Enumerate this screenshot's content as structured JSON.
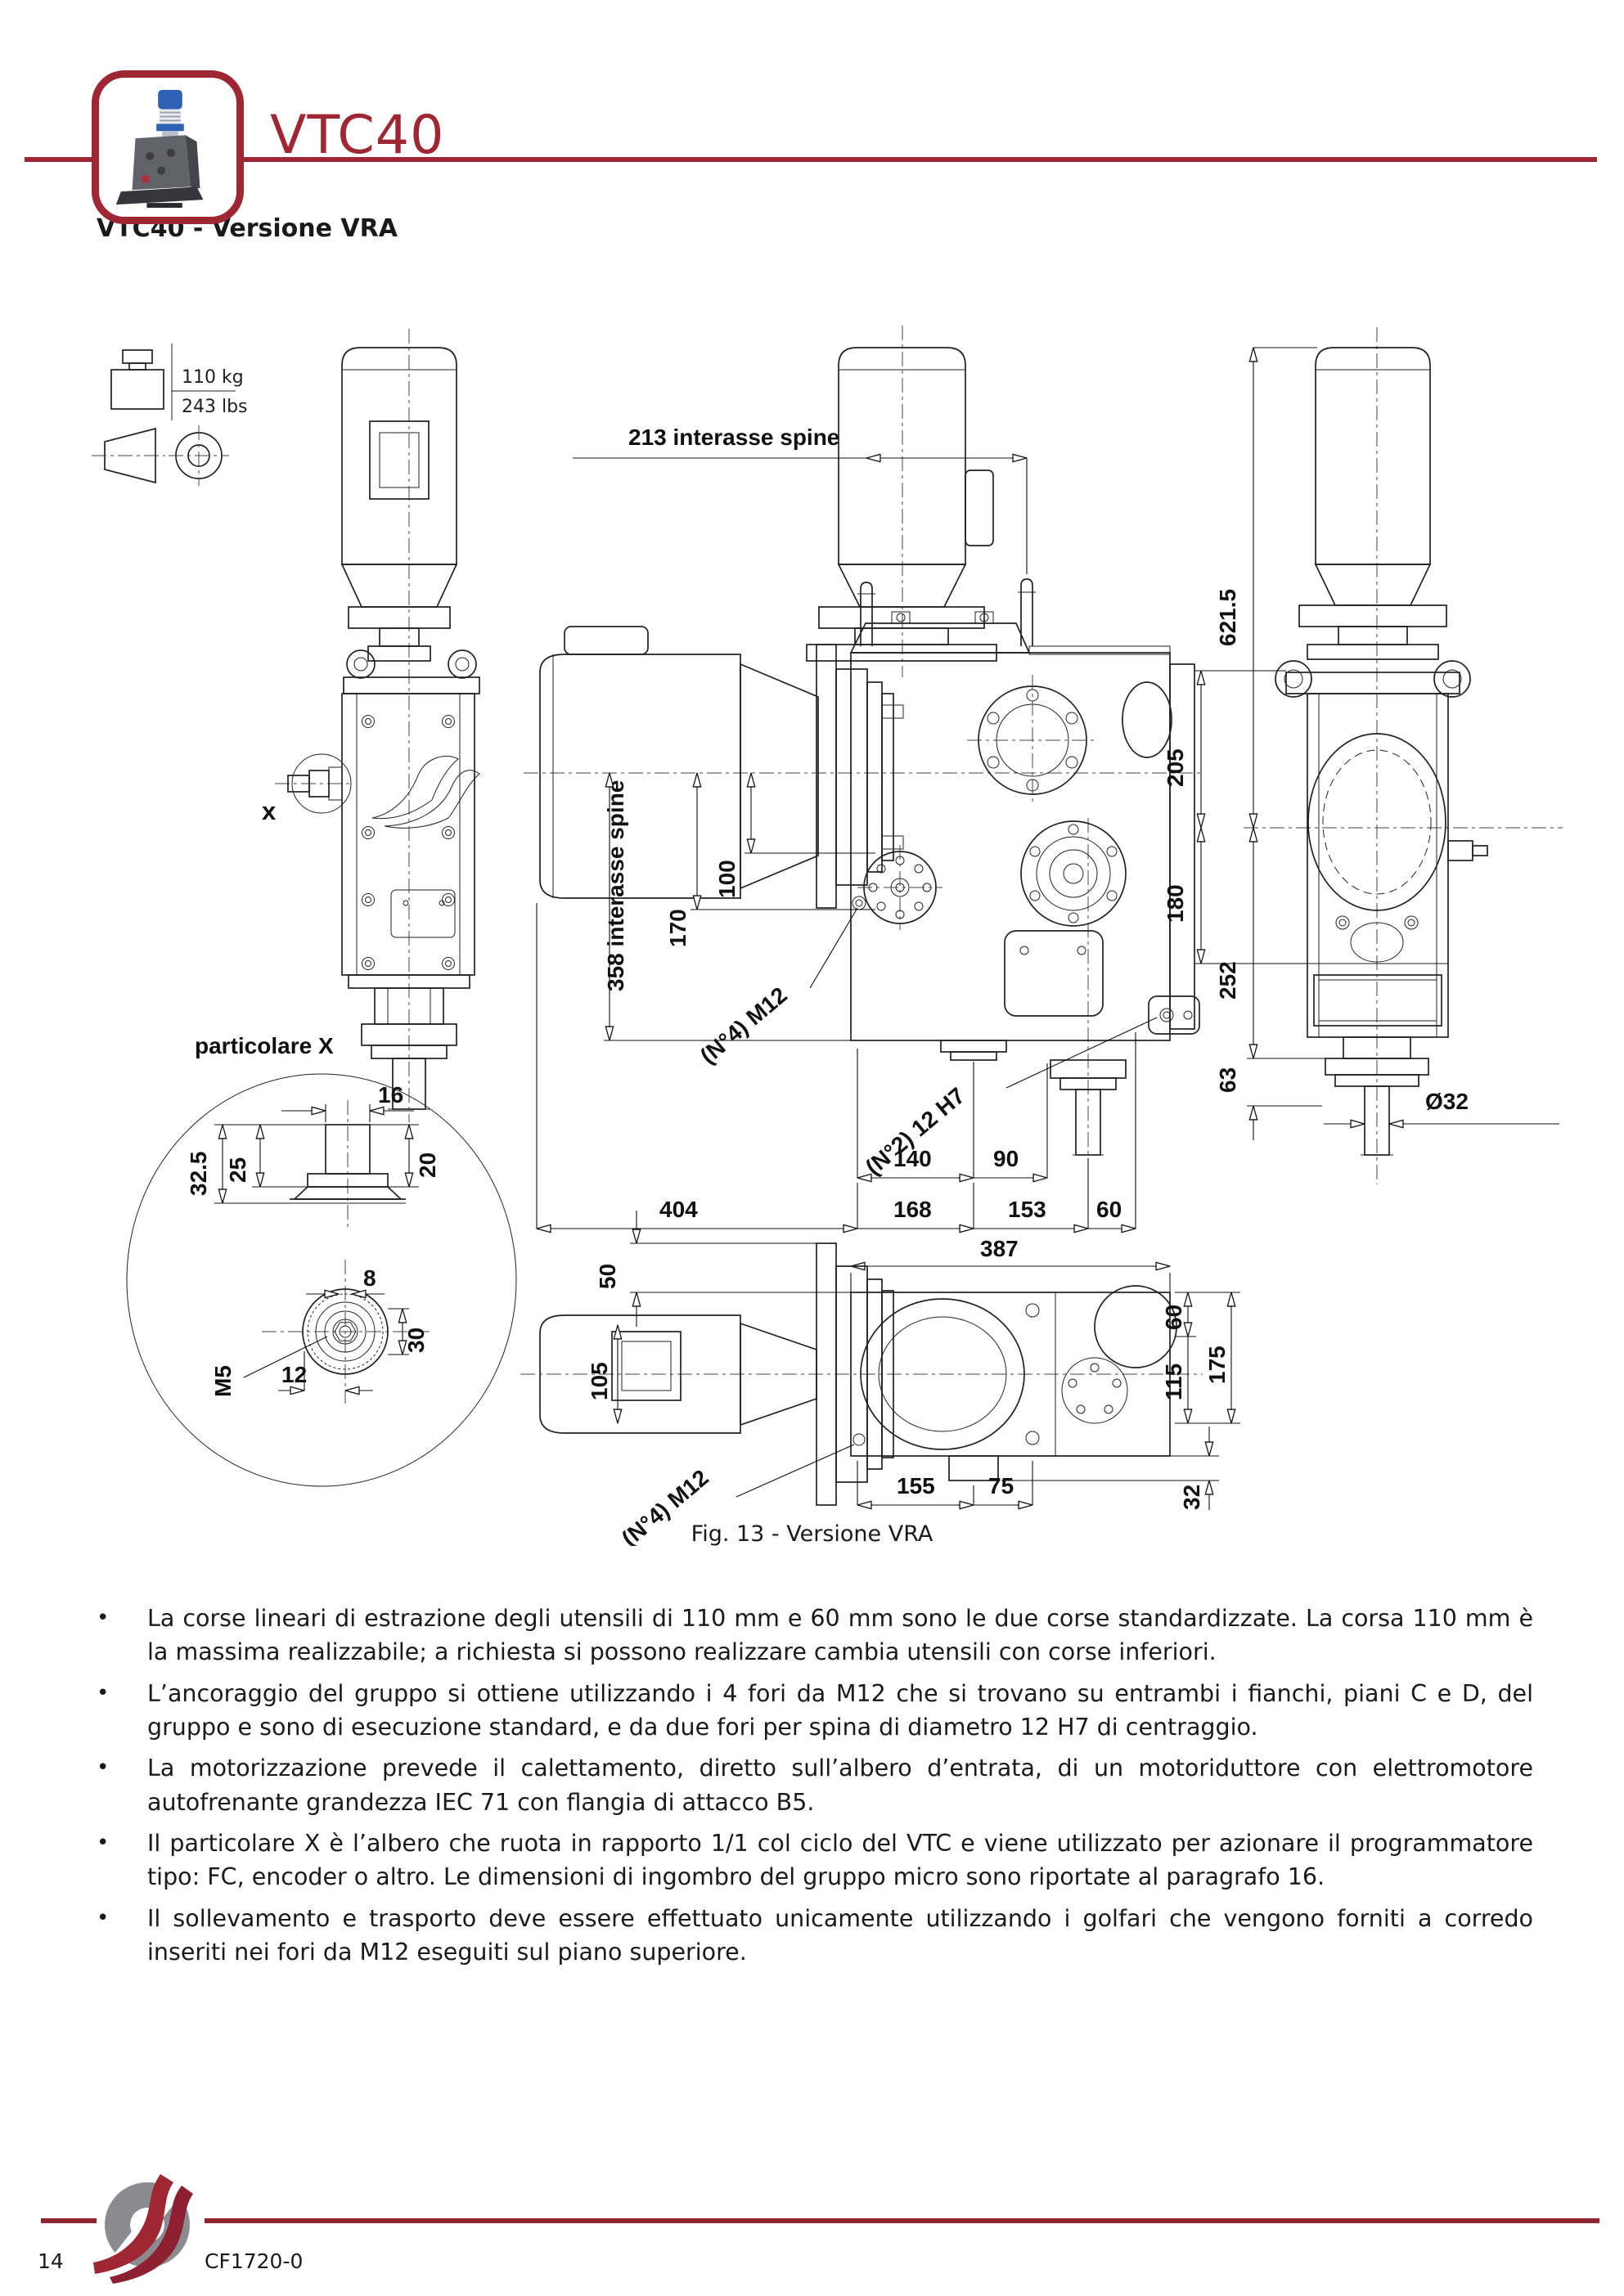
{
  "header": {
    "logo_title": "VTC40"
  },
  "title": "VTC40 - Versione VRA",
  "weight": {
    "kg": "110 kg",
    "lbs": "243 lbs"
  },
  "figure": {
    "caption": "Fig. 13 - Versione VRA"
  },
  "drawing": {
    "detail_label": "particolare X",
    "x_marker": "x",
    "dims": {
      "interasse213": "213  interasse spine",
      "interasse358": "358  interasse spine",
      "d621": "621.5",
      "d205": "205",
      "d180": "180",
      "d252": "252",
      "d63": "63",
      "dia32": "Ø32",
      "d170": "170",
      "d100": "100",
      "m12_side": "(N°4) M12",
      "h7": "(N°2) 12 H7",
      "d140": "140",
      "d90": "90",
      "d404": "404",
      "d168": "168",
      "d153": "153",
      "d60": "60",
      "d387": "387",
      "d50": "50",
      "d105": "105",
      "d155": "155",
      "d75": "75",
      "m12_top": "(N°4) M12",
      "d60b": "60",
      "d115": "115",
      "d175": "175",
      "d32": "32",
      "d16": "16",
      "d32_5": "32.5",
      "d25": "25",
      "d20": "20",
      "d8": "8",
      "d30": "30",
      "d12": "12",
      "m5": "M5"
    }
  },
  "bullets": [
    "La corse lineari di estrazione degli utensili di 110 mm e 60 mm sono le due corse standardizzate. La corsa 110 mm è la massima realizzabile; a richiesta si possono realizzare cambia utensili con corse inferiori.",
    "L’ancoraggio del gruppo si ottiene utilizzando i 4 fori da M12 che si trovano su entrambi i fianchi, piani C e D, del gruppo e sono di esecuzione standard, e da due fori per spina di diametro 12 H7 di centraggio.",
    "La motorizzazione prevede il calettamento, diretto sull’albero d’entrata, di un motoriduttore con elettromotore autofrenante grandezza IEC 71 con flangia di attacco  B5.",
    "Il particolare X è l’albero che ruota in rapporto 1/1 col ciclo del VTC e viene utilizzato per azionare il programmatore tipo: FC, encoder o altro. Le dimensioni di ingombro del gruppo micro sono riportate al paragrafo  16.",
    "Il sollevamento e trasporto deve essere effettuato unicamente utilizzando i golfari che vengono forniti a corredo inseriti nei fori da M12 eseguiti sul piano superiore."
  ],
  "footer": {
    "page_number": "14",
    "doc_code": "CF1720-0"
  },
  "colors": {
    "accent": "#9E2733"
  }
}
